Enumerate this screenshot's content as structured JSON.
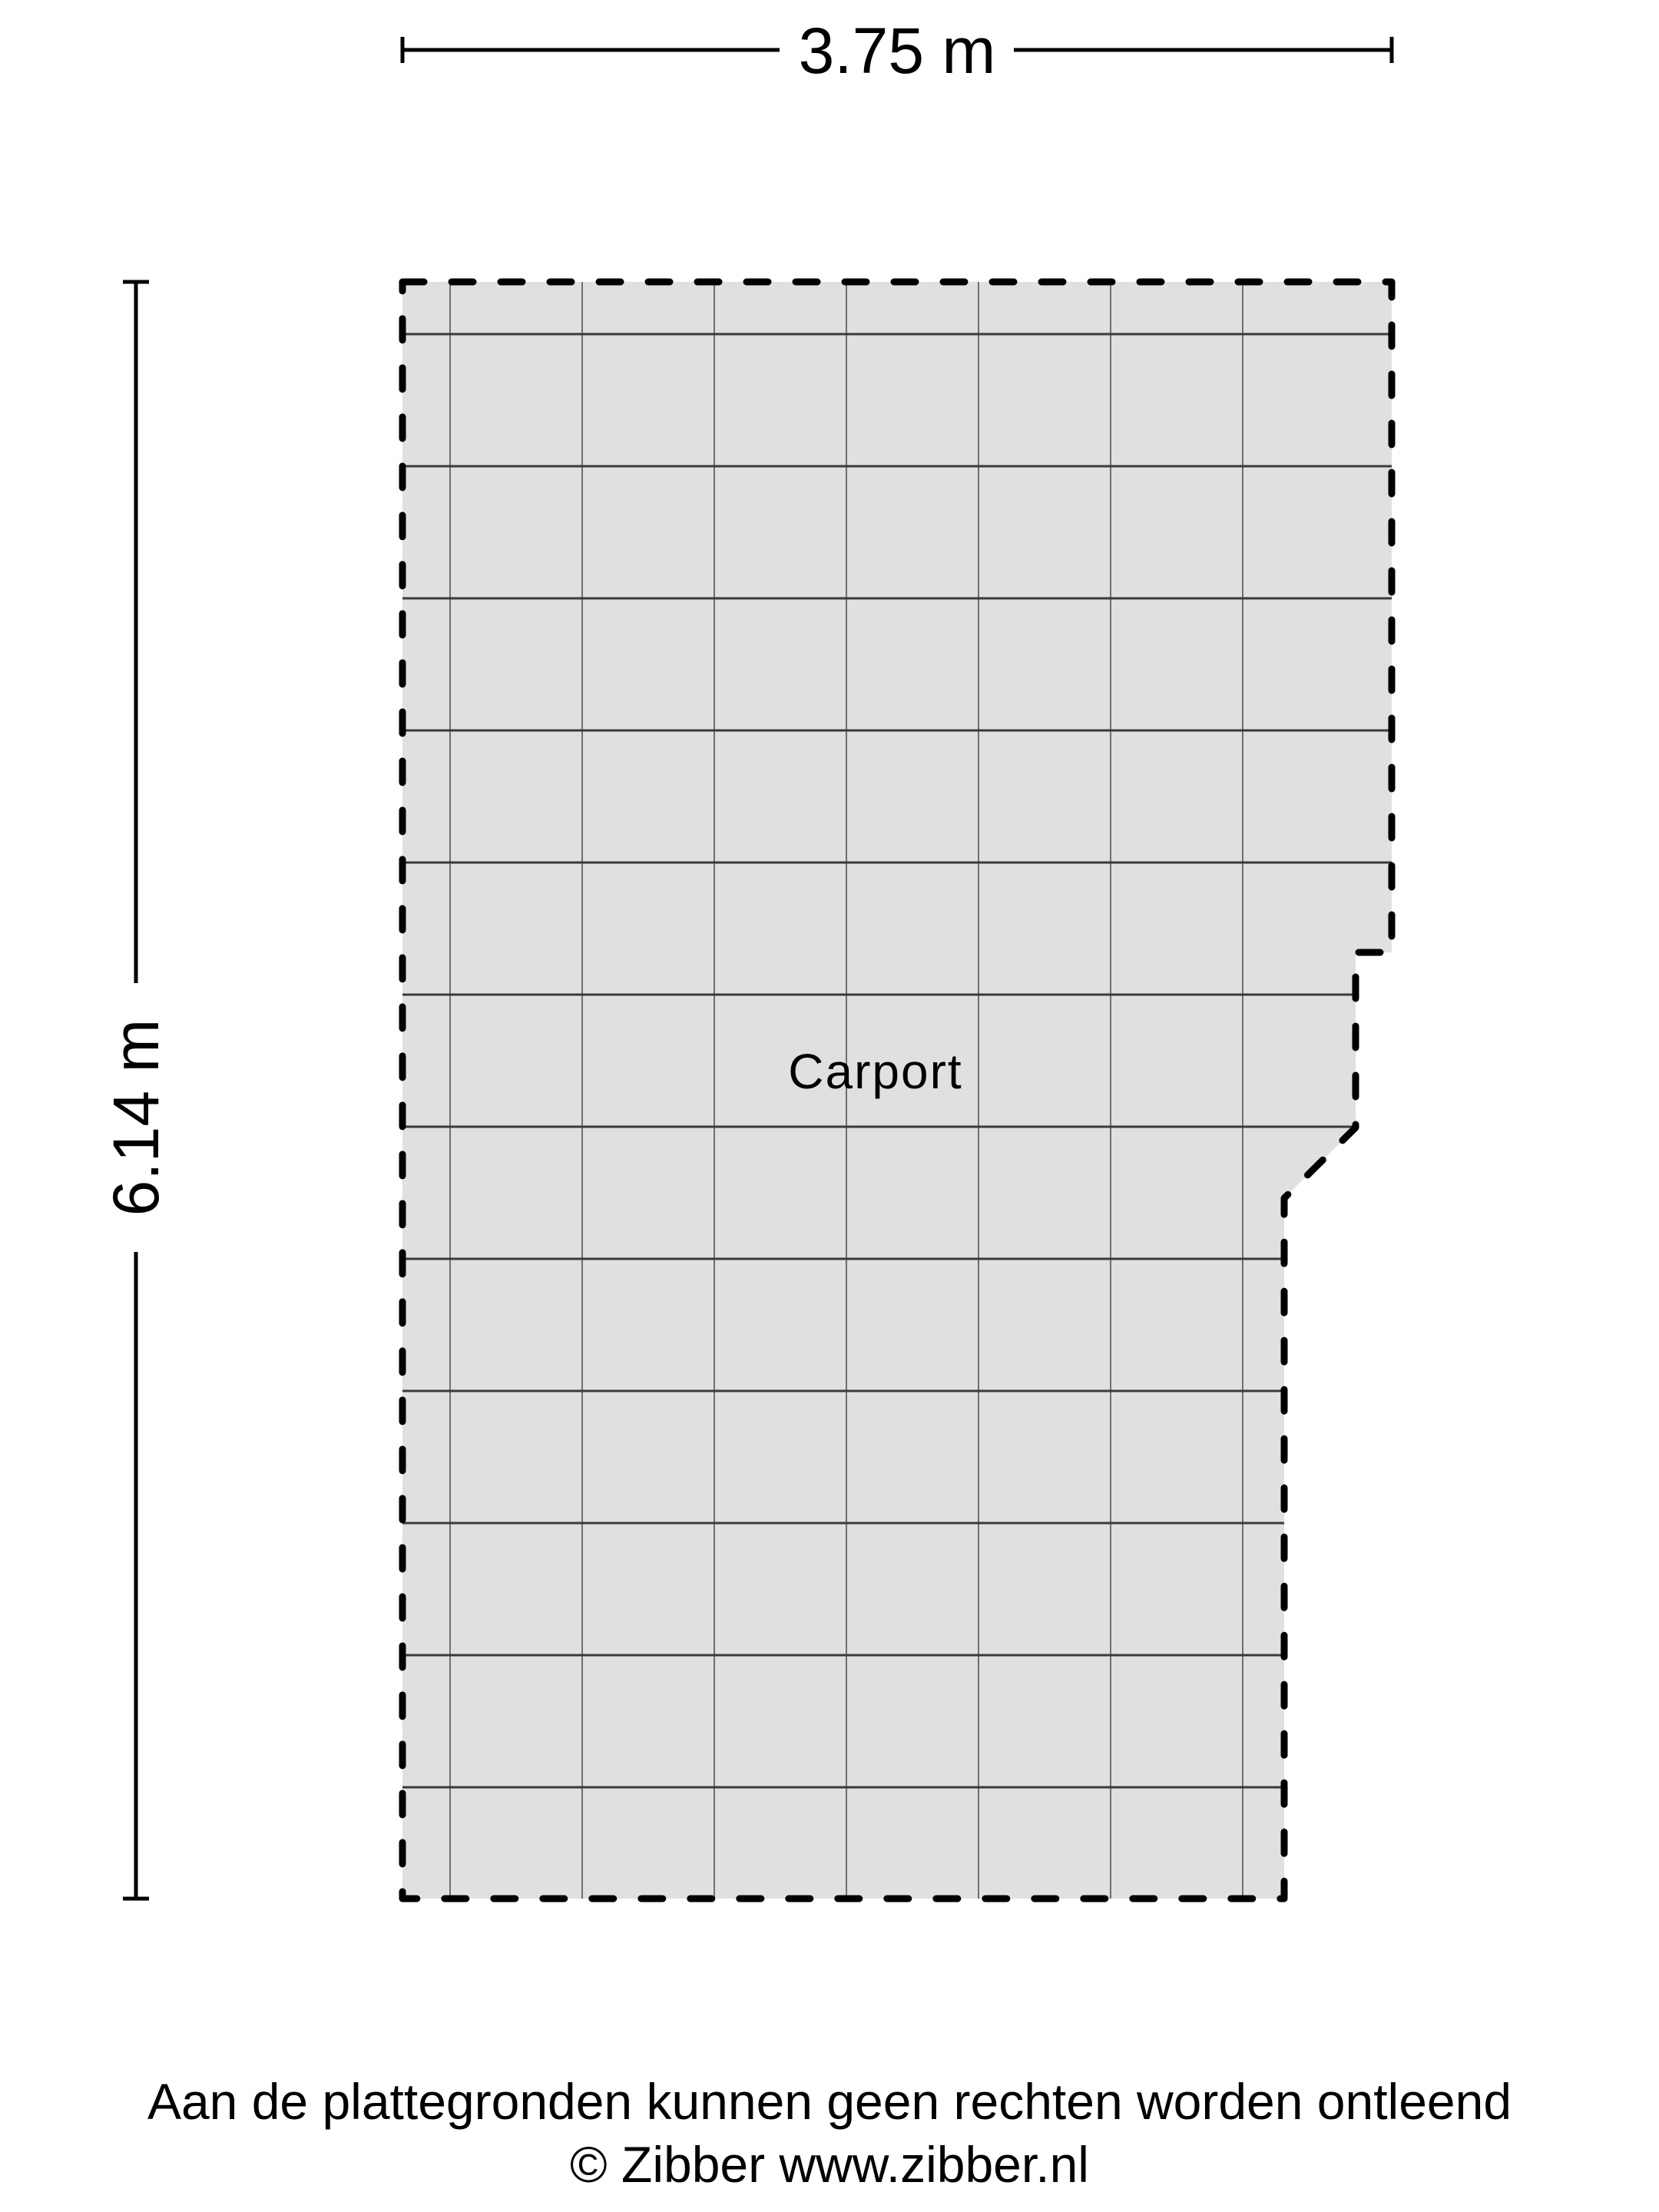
{
  "floor_plan": {
    "room_label": "Carport",
    "width_dimension_label": "3.75 m",
    "height_dimension_label": "6.14 m",
    "colors": {
      "background": "#ffffff",
      "floor_fill": "#e0e0e0",
      "outline": "#000000",
      "grid_line_vertical": "#6f6f6f",
      "grid_line_horizontal": "#3a3a3a",
      "text": "#000000"
    }
  },
  "footer": {
    "disclaimer": "Aan de plattegronden kunnen geen rechten worden ontleend",
    "copyright": "© Zibber www.zibber.nl"
  }
}
